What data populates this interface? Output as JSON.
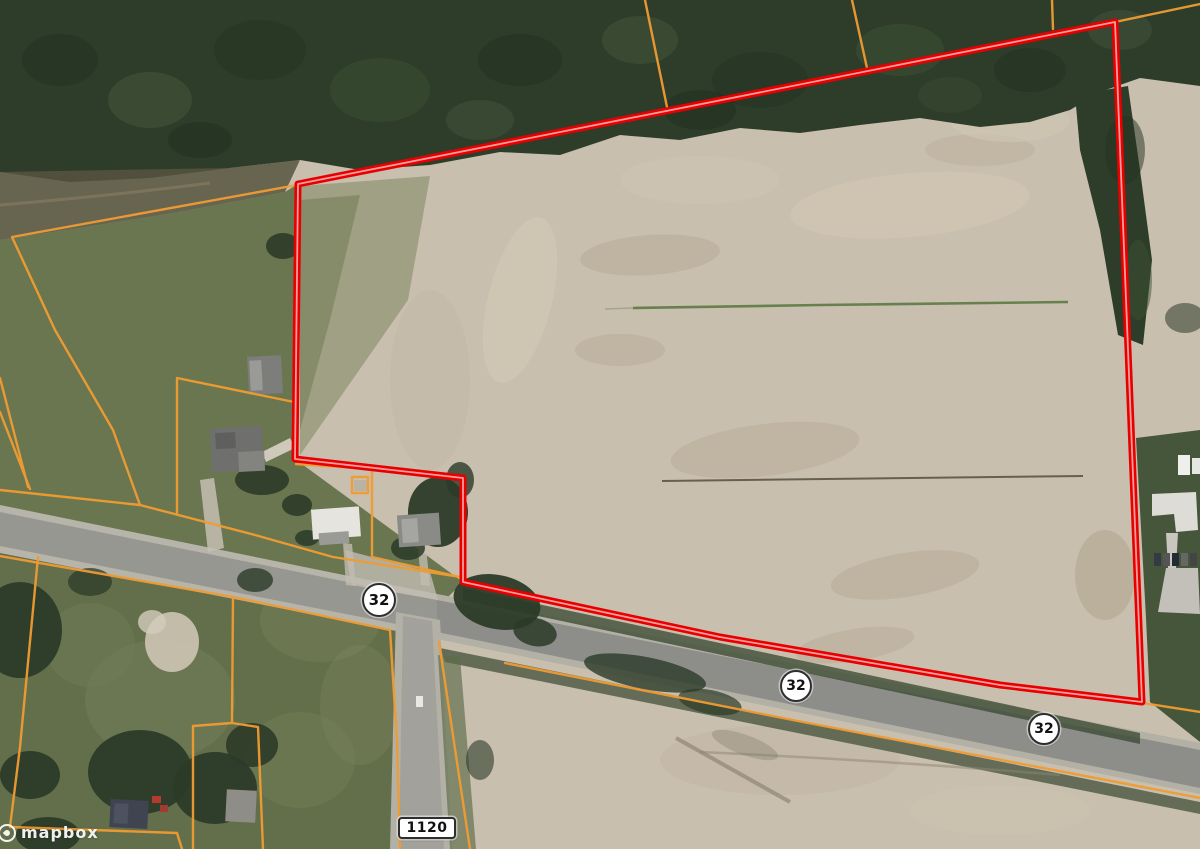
{
  "map": {
    "provider_attribution": {
      "logo_text": "mapbox"
    },
    "road_shields": [
      {
        "shape": "circle",
        "label": "32",
        "road_class": "state-route"
      },
      {
        "shape": "circle",
        "label": "32",
        "road_class": "state-route"
      },
      {
        "shape": "circle",
        "label": "32",
        "road_class": "state-route"
      },
      {
        "shape": "rounded-rect",
        "label": "1120",
        "road_class": "local-route"
      }
    ],
    "overlays": {
      "property_boundary": {
        "color": "#e60000",
        "highlight": "#ff9b9b"
      },
      "parcel_lines": {
        "color": "#f09c32"
      }
    },
    "shield_style": {
      "fill": "#ffffff",
      "border": "#2e2e2e",
      "text_color": "#111111"
    },
    "basemap": {
      "style": "satellite",
      "field_color": "#c9bfae",
      "forest_color": "#2e3d2a",
      "grass_color": "#69764f"
    }
  }
}
